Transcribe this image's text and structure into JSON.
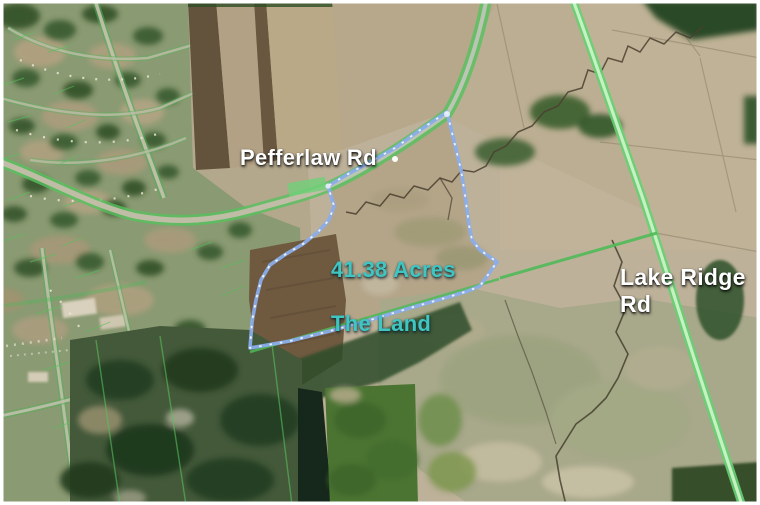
{
  "map": {
    "description": "Aerial satellite view of 41.38 acre land parcel at Pefferlaw Rd and Lake Ridge Rd",
    "labels": {
      "road_pefferlaw": "Pefferlaw Rd",
      "road_lake_ridge": "Lake Ridge Rd",
      "parcel_acreage": "41.38 Acres",
      "parcel_title": "The Land"
    },
    "parcel": {
      "area_acres": 41.38,
      "boundary_color": "#8aadea",
      "boundary_style": "solid blue with white dashes"
    },
    "roads": [
      {
        "name": "Pefferlaw Rd",
        "highlight_color": "#5cc463"
      },
      {
        "name": "Lake Ridge Rd",
        "highlight_color": "#66d072"
      }
    ],
    "colors": {
      "label_white": "#ffffff",
      "label_teal": "#3fc6c2",
      "field_tan": "#b3a78c",
      "forest_dark_green": "#2b4a26",
      "wetland_olive": "#a8a88b"
    }
  }
}
